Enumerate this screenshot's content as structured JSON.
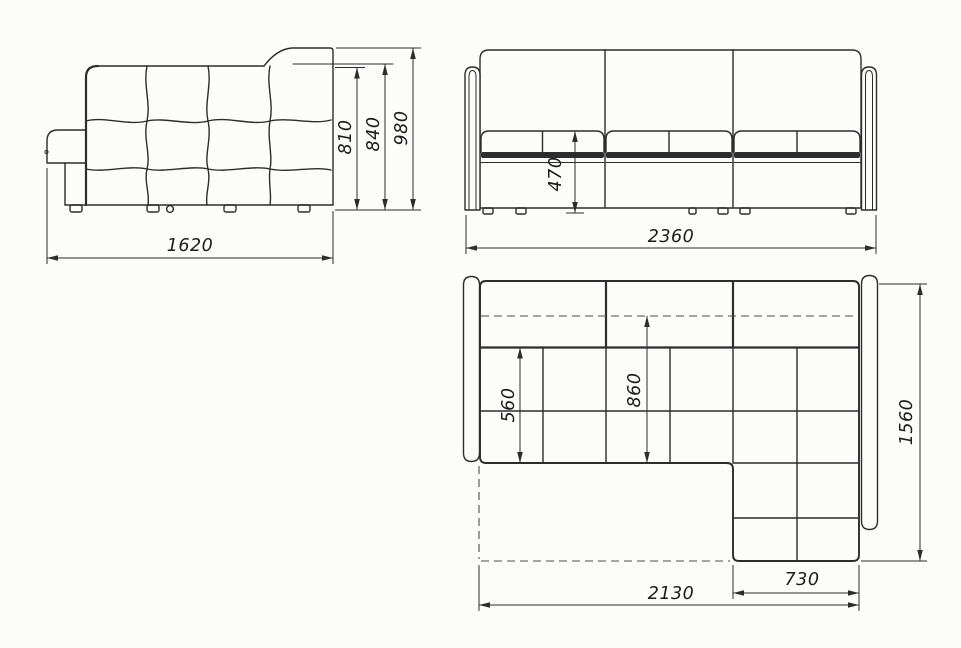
{
  "drawing": {
    "line_color": "#2d2d2d",
    "background_color": "#fcfcfb",
    "side_view": {
      "dims": {
        "backrest_height": "810",
        "headrest_ledge_height": "840",
        "total_height": "980",
        "depth": "1620"
      }
    },
    "front_view": {
      "dims": {
        "seat_height": "470",
        "total_width": "2360"
      }
    },
    "plan_view": {
      "dims": {
        "seat_depth": "560",
        "sleeping_depth": "860",
        "total_depth": "1560",
        "sleeping_length": "2130",
        "chaise_width": "730"
      }
    }
  }
}
